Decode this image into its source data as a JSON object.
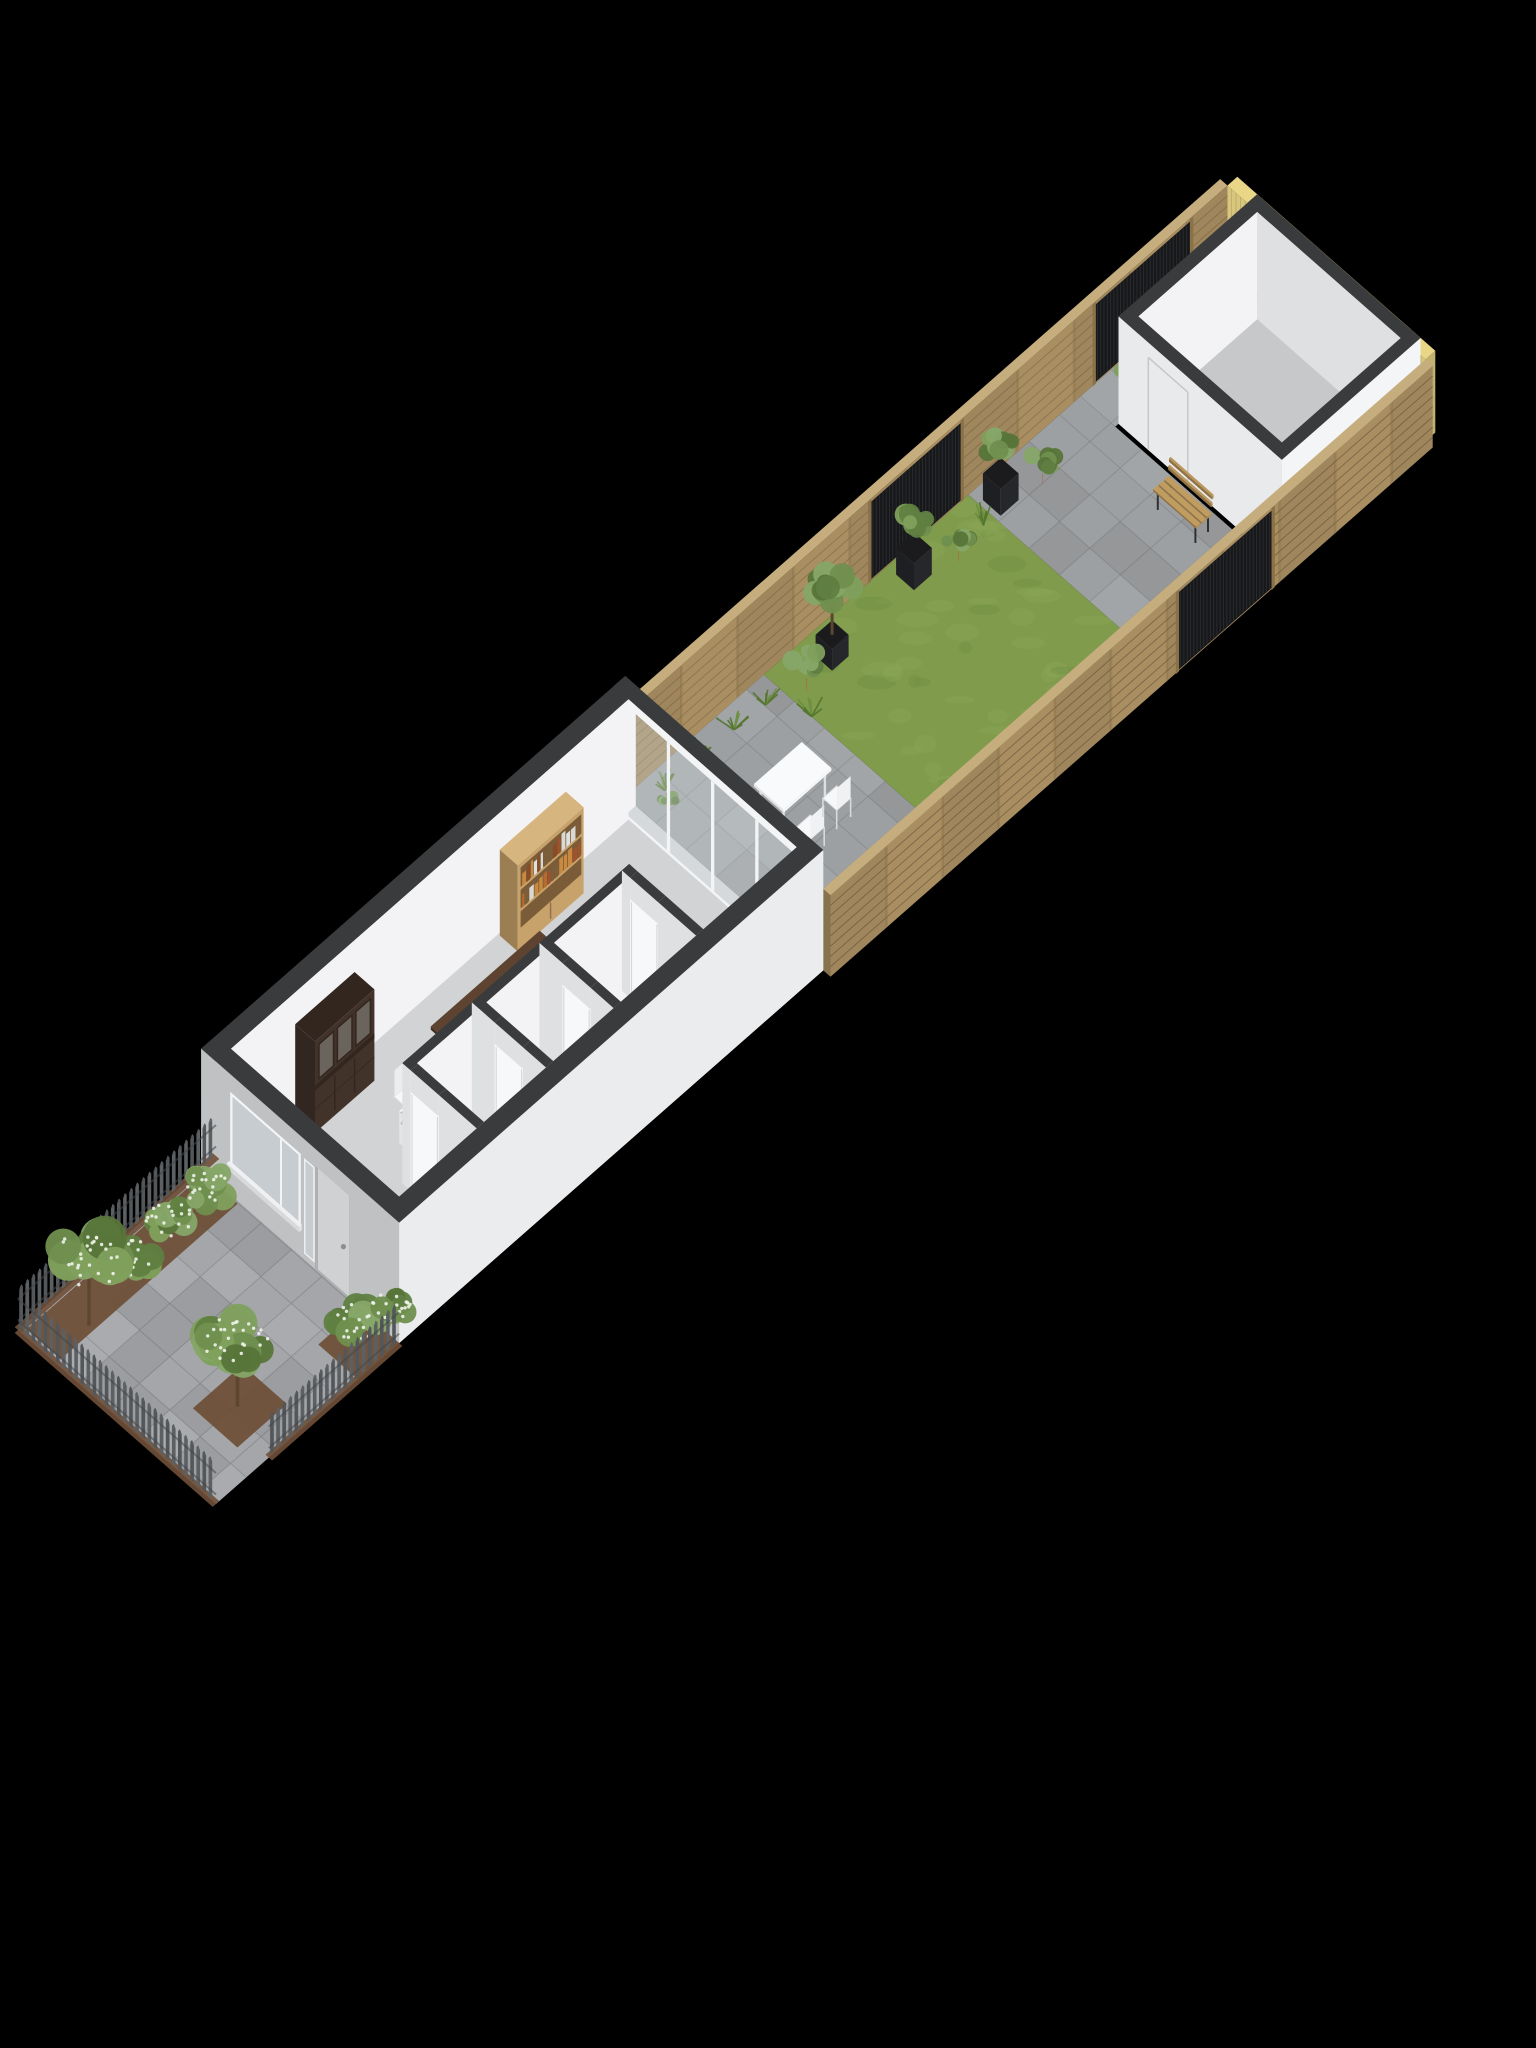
{
  "scene": {
    "description": "3D axonometric floorplan render of a long narrow row-house plot with front yard, house interior, back garden and shed on a black background",
    "background": "#000000",
    "projection": {
      "kx": 33,
      "ky": 29,
      "x0": 18,
      "y0": 1330,
      "hz": 43
    },
    "plot": {
      "length": 37,
      "width": 6
    },
    "palette": {
      "wall_cap": "#3a3b3d",
      "wall_outer_u": "#bfc1c3",
      "wall_outer_v": "#ebecee",
      "wall_inner": "#f3f3f5",
      "wall_inner_shade": "#dfe0e2",
      "house_floor": "#d2d3d5",
      "shed_floor": "#c6c8ca",
      "paver": "#9da0a2",
      "paver_front": "#a4a6a9",
      "paver_line": "#85888b",
      "grass": "#7f9b4b",
      "grass_light": "#8fa958",
      "grass_dark": "#6d8a42",
      "fence_wood": "#a88e61",
      "fence_wood_line": "#6e563a",
      "fence_top": "#c6ad7d",
      "fence_outer": "#9d8357",
      "fence_yellow": "#d8c67c",
      "slat_dark": "#17181a",
      "slat_line": "#303236",
      "slat_post": "#8a7148",
      "picket": "#5c6063",
      "picket_alt": "#53575a",
      "soil": "#6f5038",
      "terracotta": "#c06328",
      "terracotta_rim": "#d4783c",
      "terracotta_dark": "#8e4517",
      "planter_dark": "#26272a",
      "foliage": [
        "#5f7f41",
        "#6f8f4e",
        "#7fa05c",
        "#577539",
        "#86a768"
      ],
      "flower": "#eef2ea",
      "trunk": "#5d4630",
      "tuft": "#55762f",
      "hutch": "#42332a",
      "hutch_dark": "#32261f",
      "hutch_pane": "#6b645c",
      "bookshelf": "#c8a26b",
      "bookshelf_edge": "#d7b57e",
      "bookshelf_shadow": "#7a5c38",
      "book_colors": [
        "#b66a2e",
        "#8a4b26",
        "#c9893f",
        "#e0e0dc",
        "#7c5e3a",
        "#a0522d",
        "#d8d8d4"
      ],
      "counter_top": "#523a29",
      "counter_top_light": "#5d4330",
      "white_furniture": "#f7f8f9",
      "white_furniture_shade": "#e3e4e6",
      "glass": "#dde5e9",
      "glass_opacity": 0.32,
      "window_glass": "#c6ccd0",
      "frame_white": "#f3f4f5",
      "door_face": "#cfd1d3",
      "door_jamb": "#aeb0b2",
      "handle": "#8b8e91",
      "bench_wood": "#b39058",
      "bench_leg": "#2e2f31",
      "bottle": "#0c0d0f",
      "bottle_tip": "#c2651f",
      "niche_floor": "#191a1c"
    },
    "front_yard": {
      "u0": 0,
      "u1": 5.55,
      "soil_patches": [
        [
          0.15,
          5.5,
          0.12,
          1.15
        ],
        [
          1.3,
          2.8,
          4.0,
          5.35
        ],
        [
          4.3,
          5.55,
          4.8,
          6.0
        ]
      ],
      "picket_height": 0.92,
      "fences": [
        {
          "axis": "u",
          "c": 0,
          "a0": 0,
          "a1": 6.0
        },
        {
          "axis": "v",
          "c": 0,
          "a0": 0,
          "a1": 6.0
        },
        {
          "axis": "u",
          "c": 6,
          "a0": 1.6,
          "a1": 5.55
        }
      ],
      "bushes": [
        [
          2.6,
          0.75,
          0.72
        ],
        [
          3.9,
          0.7,
          0.66
        ],
        [
          5.05,
          0.78,
          0.7
        ],
        [
          5.0,
          5.3,
          0.72
        ],
        [
          5.75,
          5.55,
          0.55
        ]
      ],
      "trees": [
        [
          1.15,
          1.0,
          1.05
        ],
        [
          2.0,
          4.65,
          0.95
        ]
      ]
    },
    "house": {
      "u0": 5.55,
      "u1": 18.4,
      "wall_t": 0.45,
      "height": 2.8,
      "window": {
        "v0": 0.95,
        "v1": 2.95,
        "z0": 0.78,
        "z1": 2.32,
        "mullion": 2.42
      },
      "sidelight": {
        "v0": 3.16,
        "v1": 3.4,
        "z0": 0.18,
        "z1": 2.32
      },
      "door": {
        "v0": 3.5,
        "v1": 4.45,
        "z1": 2.35,
        "handle_v": 4.27,
        "handle_z": 1.05
      },
      "glass_wall": {
        "u": 18.05,
        "t": 0.35,
        "jamb": 0.32,
        "posts": [
          0.32,
          1.66,
          3.0,
          4.34,
          5.68
        ],
        "beam_z": 2.6
      },
      "partition_long": {
        "v": 3.3,
        "t": 0.22,
        "u0": 8.35,
        "u1": 15.0
      },
      "partitions_cross": [
        {
          "u": 15.0,
          "door": [
            3.55,
            4.4
          ]
        },
        {
          "u": 12.5,
          "door": [
            4.0,
            4.85
          ]
        },
        {
          "u": 10.45,
          "door": [
            4.0,
            4.85
          ]
        },
        {
          "u": 8.35,
          "door": [
            3.55,
            4.4
          ]
        }
      ],
      "hutch": {
        "u0": 7.9,
        "u1": 9.7,
        "v0": 0.5,
        "v1": 1.1,
        "h": 2.12
      },
      "bookshelf": {
        "u0": 14.1,
        "u1": 16.1,
        "v0": 0.5,
        "v1": 1.04,
        "h": 2.0
      },
      "island": {
        "u0": 10.6,
        "u1": 13.9,
        "v0": 2.05,
        "v1": 2.95,
        "h": 1.12,
        "top_over": 0.14
      },
      "stools": [
        11.1,
        11.9,
        12.7,
        13.45
      ],
      "stool_v": 3.18,
      "desk": {
        "u0": 9.0,
        "u1": 10.1,
        "v0": 2.55,
        "v1": 3.15,
        "h": 0.74
      },
      "office_chair": [
        9.55,
        2.26
      ],
      "toilet": {
        "u": 11.5
      },
      "wine_niche": {
        "u0": 6.4,
        "u1": 7.6,
        "v0": 5.0,
        "v1": 5.53,
        "bottles": 4,
        "pot": [
          7.42,
          5.2
        ]
      }
    },
    "garden": {
      "patio1": [
        18.4,
        22.6
      ],
      "grass": [
        22.6,
        28.8
      ],
      "patio2": [
        28.8,
        32.2
      ],
      "corridor_v": 1.05,
      "fence_h": 1.9,
      "fence_t": 0.22,
      "slats_left": [
        [
          25.8,
          28.6
        ],
        [
          32.6,
          35.55
        ]
      ],
      "gate_right": [
        28.9,
        31.8
      ],
      "tufts": [
        [
          19.1,
          0.5
        ],
        [
          20.1,
          0.45
        ],
        [
          21.2,
          0.5
        ],
        [
          22.1,
          0.55
        ],
        [
          22.6,
          1.45
        ],
        [
          28.5,
          0.75
        ]
      ],
      "table": {
        "u0": 20.0,
        "u1": 21.45,
        "v0": 2.3,
        "v1": 3.2,
        "h": 0.73
      },
      "chairs": [
        [
          20.35,
          3.66
        ],
        [
          21.25,
          3.56
        ]
      ],
      "door_plant": [
        18.75,
        0.95
      ],
      "pots": [
        {
          "t": "terra",
          "u": 33.0,
          "v": 0.68,
          "s": 0.42
        },
        {
          "t": "terra",
          "u": 30.1,
          "v": 0.95,
          "s": 0.5
        },
        {
          "t": "bushbox",
          "u": 29.2,
          "v": 0.58,
          "s": 0.5
        },
        {
          "t": "terra",
          "u": 27.5,
          "v": 1.0,
          "s": 0.45
        },
        {
          "t": "bushbox",
          "u": 26.6,
          "v": 0.55,
          "s": 0.5
        },
        {
          "t": "tree",
          "u": 23.95,
          "v": 0.72,
          "s": 0.5
        },
        {
          "t": "terra",
          "u": 22.95,
          "v": 0.95,
          "s": 0.62
        }
      ],
      "bench": {
        "u0": 31.35,
        "u1": 31.85,
        "v0": 3.05,
        "v1": 4.35
      }
    },
    "shed": {
      "u0": 32.3,
      "u1": 36.5,
      "v0": 1.05,
      "v1": 6.0,
      "t": 0.3,
      "h": 2.5,
      "door_v": [
        1.95,
        3.15
      ]
    },
    "back_fence": {
      "u": 36.65,
      "t": 0.3,
      "h": 1.9
    }
  }
}
